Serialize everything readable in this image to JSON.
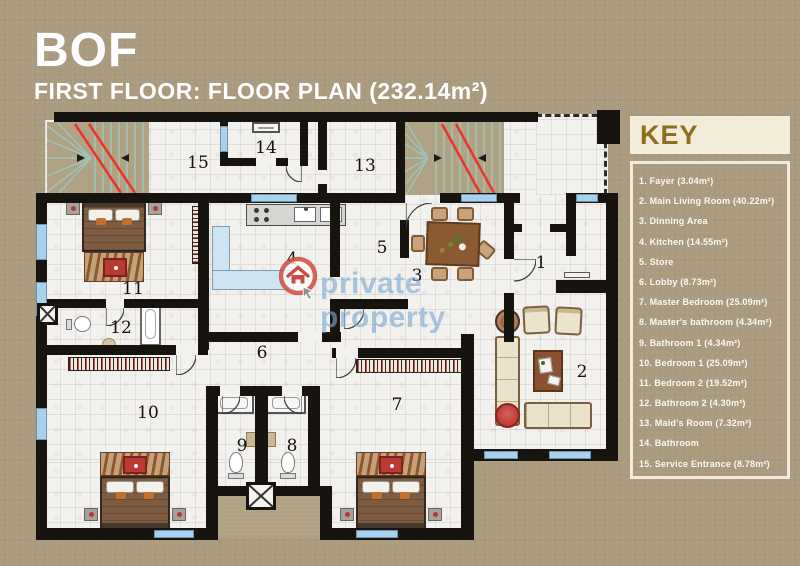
{
  "header": {
    "title": "BOF",
    "subtitle": "FIRST FLOOR: FLOOR PLAN (232.14m²)"
  },
  "watermark": {
    "text": "private property"
  },
  "key": {
    "heading": "KEY",
    "items": [
      "1. Fayer (3.04m²)",
      "2. Main Living Room (40.22m²)",
      "3. Dinning Area",
      "4. Kitchen (14.55m²)",
      "5. Store",
      "6. Lobby (8.73m²)",
      "7. Master Bedroom (25.09m²)",
      "8. Master's bathroom (4.34m²)",
      "9. Bathroom 1 (4.34m²)",
      "10. Bedroom 1 (25.09m²)",
      "11. Bedroom 2 (19.52m²)",
      "12. Bathroom 2 (4.30m²)",
      "13. Maid's Room (7.32m²)",
      "14. Bathroom",
      "15. Service Entrance (8.78m²)"
    ]
  },
  "plan": {
    "room_labels": [
      {
        "num": "1",
        "x": 541,
        "y": 263
      },
      {
        "num": "2",
        "x": 582,
        "y": 372
      },
      {
        "num": "3",
        "x": 417,
        "y": 276
      },
      {
        "num": "4",
        "x": 292,
        "y": 259
      },
      {
        "num": "5",
        "x": 382,
        "y": 248
      },
      {
        "num": "6",
        "x": 262,
        "y": 353
      },
      {
        "num": "7",
        "x": 397,
        "y": 405
      },
      {
        "num": "8",
        "x": 292,
        "y": 446
      },
      {
        "num": "9",
        "x": 242,
        "y": 446
      },
      {
        "num": "10",
        "x": 148,
        "y": 413
      },
      {
        "num": "11",
        "x": 133,
        "y": 289
      },
      {
        "num": "12",
        "x": 121,
        "y": 328
      },
      {
        "num": "13",
        "x": 365,
        "y": 166
      },
      {
        "num": "14",
        "x": 266,
        "y": 148
      },
      {
        "num": "15",
        "x": 198,
        "y": 163
      }
    ]
  },
  "colors": {
    "background": "#ab9b7e",
    "wall": "#17130f",
    "window": "#a9d1ec",
    "floor": "#f2f1ee",
    "key_panel": "#f3ecd9",
    "key_heading_text": "#8f6e1e",
    "stairs_red": "#e6372b",
    "stairs_teal": "#9cc4ba",
    "watermark_blue": "#7aa8d0",
    "logo_red": "#cd4b41"
  }
}
